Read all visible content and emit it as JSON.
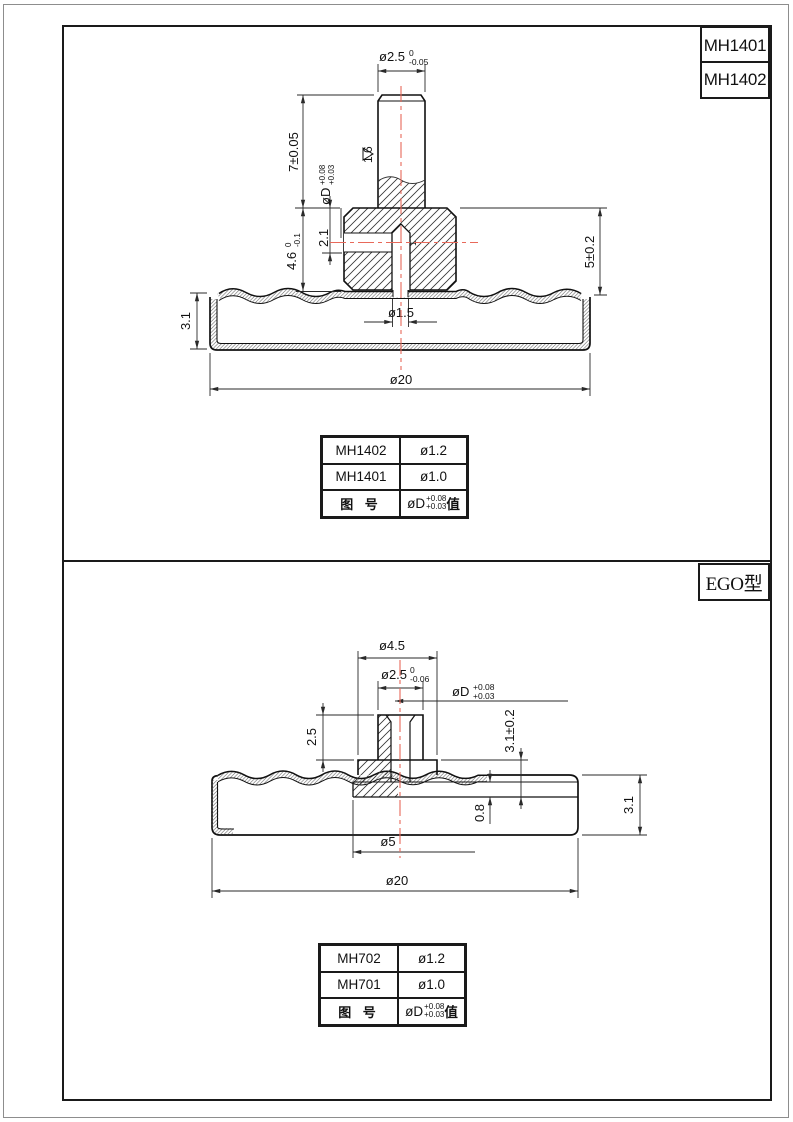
{
  "top": {
    "titles": [
      "MH1401",
      "MH1402"
    ],
    "dims": {
      "stud_dia": "ø2.5",
      "stud_dia_tol_up": "0",
      "stud_dia_tol_dn": "-0.05",
      "stud_len": "7±0.05",
      "bore": "øD",
      "bore_tol_up": "+0.08",
      "bore_tol_dn": "+0.03",
      "finish": "1.6",
      "hole_pos": "2.1",
      "body_h": "4.6",
      "body_h_tol_up": "0",
      "body_h_tol_dn": "-0.1",
      "total_h": "5±0.2",
      "cap_h": "3.1",
      "center_hole": "ø1.5",
      "bore_len": "1",
      "od": "ø20"
    },
    "table": {
      "rows": [
        {
          "model": "MH1402",
          "dia": "ø1.2"
        },
        {
          "model": "MH1401",
          "dia": "ø1.0"
        }
      ],
      "footer_label": "图 号",
      "footer_value": "øD",
      "footer_tol_up": "+0.08",
      "footer_tol_dn": "+0.03",
      "footer_suffix": "值"
    }
  },
  "bottom": {
    "type_label": "EGO型",
    "dims": {
      "flange_dia": "ø4.5",
      "boss_dia": "ø2.5",
      "boss_dia_tol_up": "0",
      "boss_dia_tol_dn": "-0.06",
      "bore": "øD",
      "bore_tol_up": "+0.08",
      "bore_tol_dn": "+0.03",
      "boss_h": "2.5",
      "insert_h": "3.1±0.2",
      "cap_h": "3.1",
      "plate_t": "0.8",
      "plate_dia": "ø5",
      "od": "ø20"
    },
    "table": {
      "rows": [
        {
          "model": "MH702",
          "dia": "ø1.2"
        },
        {
          "model": "MH701",
          "dia": "ø1.0"
        }
      ],
      "footer_label": "图 号",
      "footer_value": "øD",
      "footer_tol_up": "+0.08",
      "footer_tol_dn": "+0.03",
      "footer_suffix": "值"
    }
  },
  "colors": {
    "centerline": "#e8695a",
    "line": "#111111",
    "dimline": "#2a2a2a"
  }
}
